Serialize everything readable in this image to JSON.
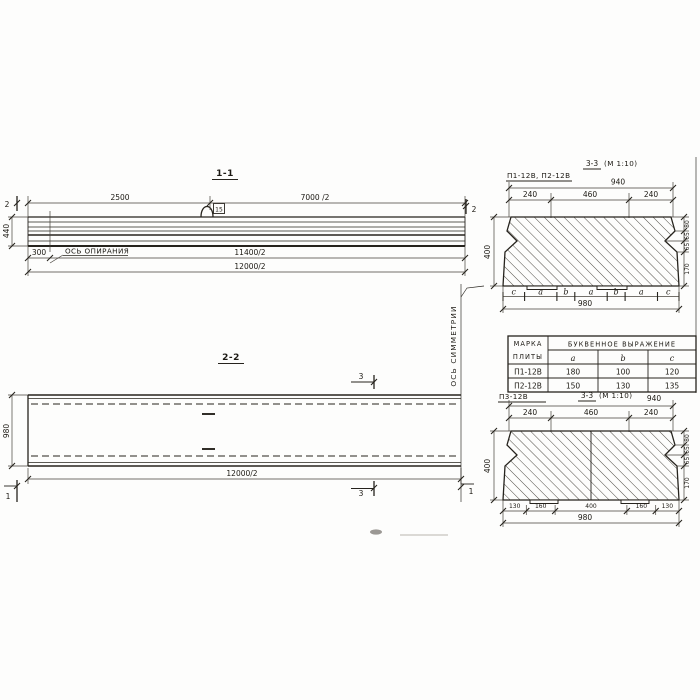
{
  "drawing": {
    "section_1_1": {
      "title": "1-1",
      "cut_mark_2": "2",
      "dim_2500": "2500",
      "dim_7000_2": "7000 /2",
      "dim_height": "440",
      "dim_300": "300",
      "dim_11400_2": "11400/2",
      "dim_12000_2": "12000/2",
      "support_axis_label": "ОСЬ ОПИРАНИЯ",
      "loop_tag": "15"
    },
    "section_2_2": {
      "title": "2-2",
      "cut_mark_3": "3",
      "cut_mark_1": "1",
      "dim_width": "980",
      "dim_length": "12000/2",
      "symmetry_axis_label": "ОСЬ СИММЕТРИИ"
    },
    "section_top": {
      "plate_label": "П1-12В, П2-12В",
      "title": "3-3",
      "scale": "(М 1:10)",
      "dim_940": "940",
      "dim_240l": "240",
      "dim_460": "460",
      "dim_240r": "240",
      "dim_400": "400",
      "right_dims": [
        "80",
        "65",
        "65",
        "170"
      ],
      "letters": [
        "c",
        "a",
        "b",
        "a",
        "b",
        "a",
        "c"
      ],
      "dim_980": "980"
    },
    "table": {
      "header_col1_line1": "МАРКА",
      "header_col1_line2": "ПЛИТЫ",
      "header_span": "БУКВЕННОЕ  ВЫРАЖЕНИЕ",
      "cols": [
        "a",
        "b",
        "c"
      ],
      "rows": [
        {
          "mark": "П1-12В",
          "a": "180",
          "b": "100",
          "c": "120"
        },
        {
          "mark": "П2-12В",
          "a": "150",
          "b": "130",
          "c": "135"
        }
      ]
    },
    "section_bottom": {
      "plate_label": "П3-12В",
      "title": "3-3",
      "scale": "(М 1:10)",
      "dim_940": "940",
      "dim_240l": "240",
      "dim_460": "460",
      "dim_240r": "240",
      "dim_400": "400",
      "right_dims": [
        "80",
        "65",
        "65",
        "170"
      ],
      "bottom_dims": [
        "130",
        "160",
        "400",
        "160",
        "130"
      ],
      "dim_980": "980"
    }
  }
}
